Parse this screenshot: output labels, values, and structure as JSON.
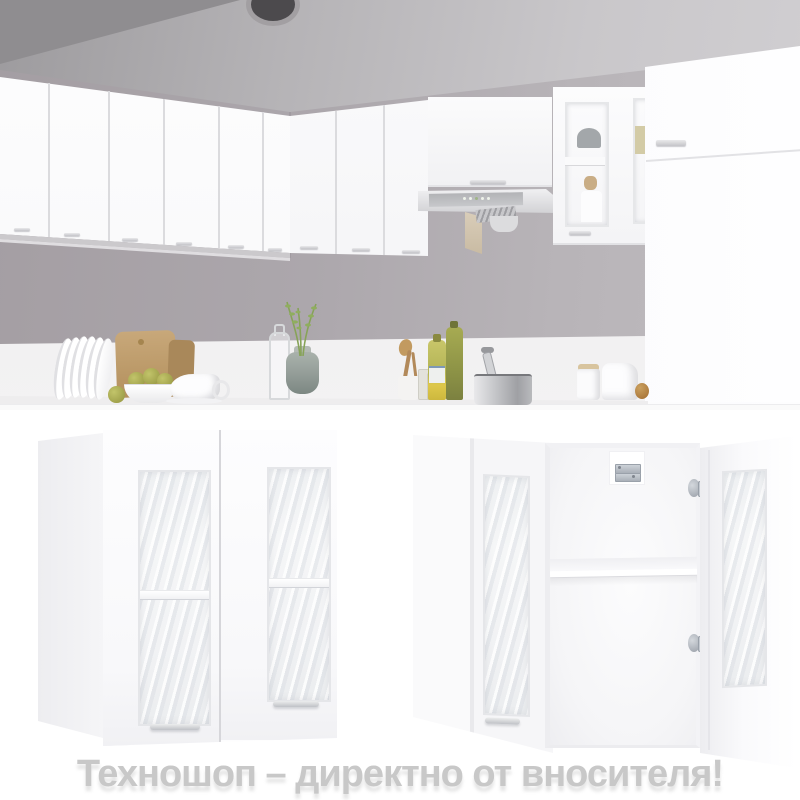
{
  "watermark": {
    "text": "Техношоп – директно от вносителя!"
  },
  "theme": {
    "watermark-color": "#c8c8c8",
    "wall-color": "#a49ea3",
    "cabinet-white": "#fdfdfe",
    "metal-gray": "#aab0b8"
  }
}
